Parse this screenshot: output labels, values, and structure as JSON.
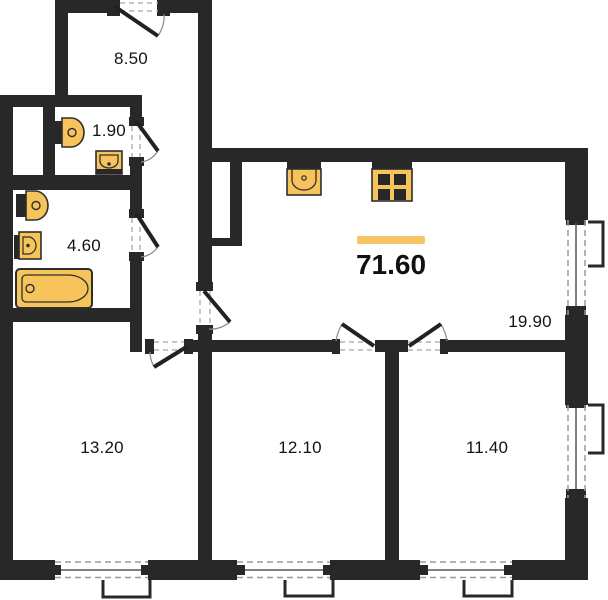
{
  "plan": {
    "total_area_label": "71.60",
    "rooms": {
      "hallway": "8.50",
      "wc": "1.90",
      "bathroom": "4.60",
      "living_kitchen": "19.90",
      "room_left": "13.20",
      "room_middle": "12.10",
      "room_right": "11.40"
    },
    "colors": {
      "wall": "#282828",
      "fixture_fill": "#F6C45A",
      "highlight_bar": "#F2C566",
      "background": "#FFFFFF"
    },
    "fixtures": [
      "toilet",
      "sink",
      "bathtub",
      "kitchen-sink",
      "stove"
    ],
    "features": [
      "entrance-door",
      "interior-doors",
      "windows",
      "ventilation-shaft"
    ]
  }
}
